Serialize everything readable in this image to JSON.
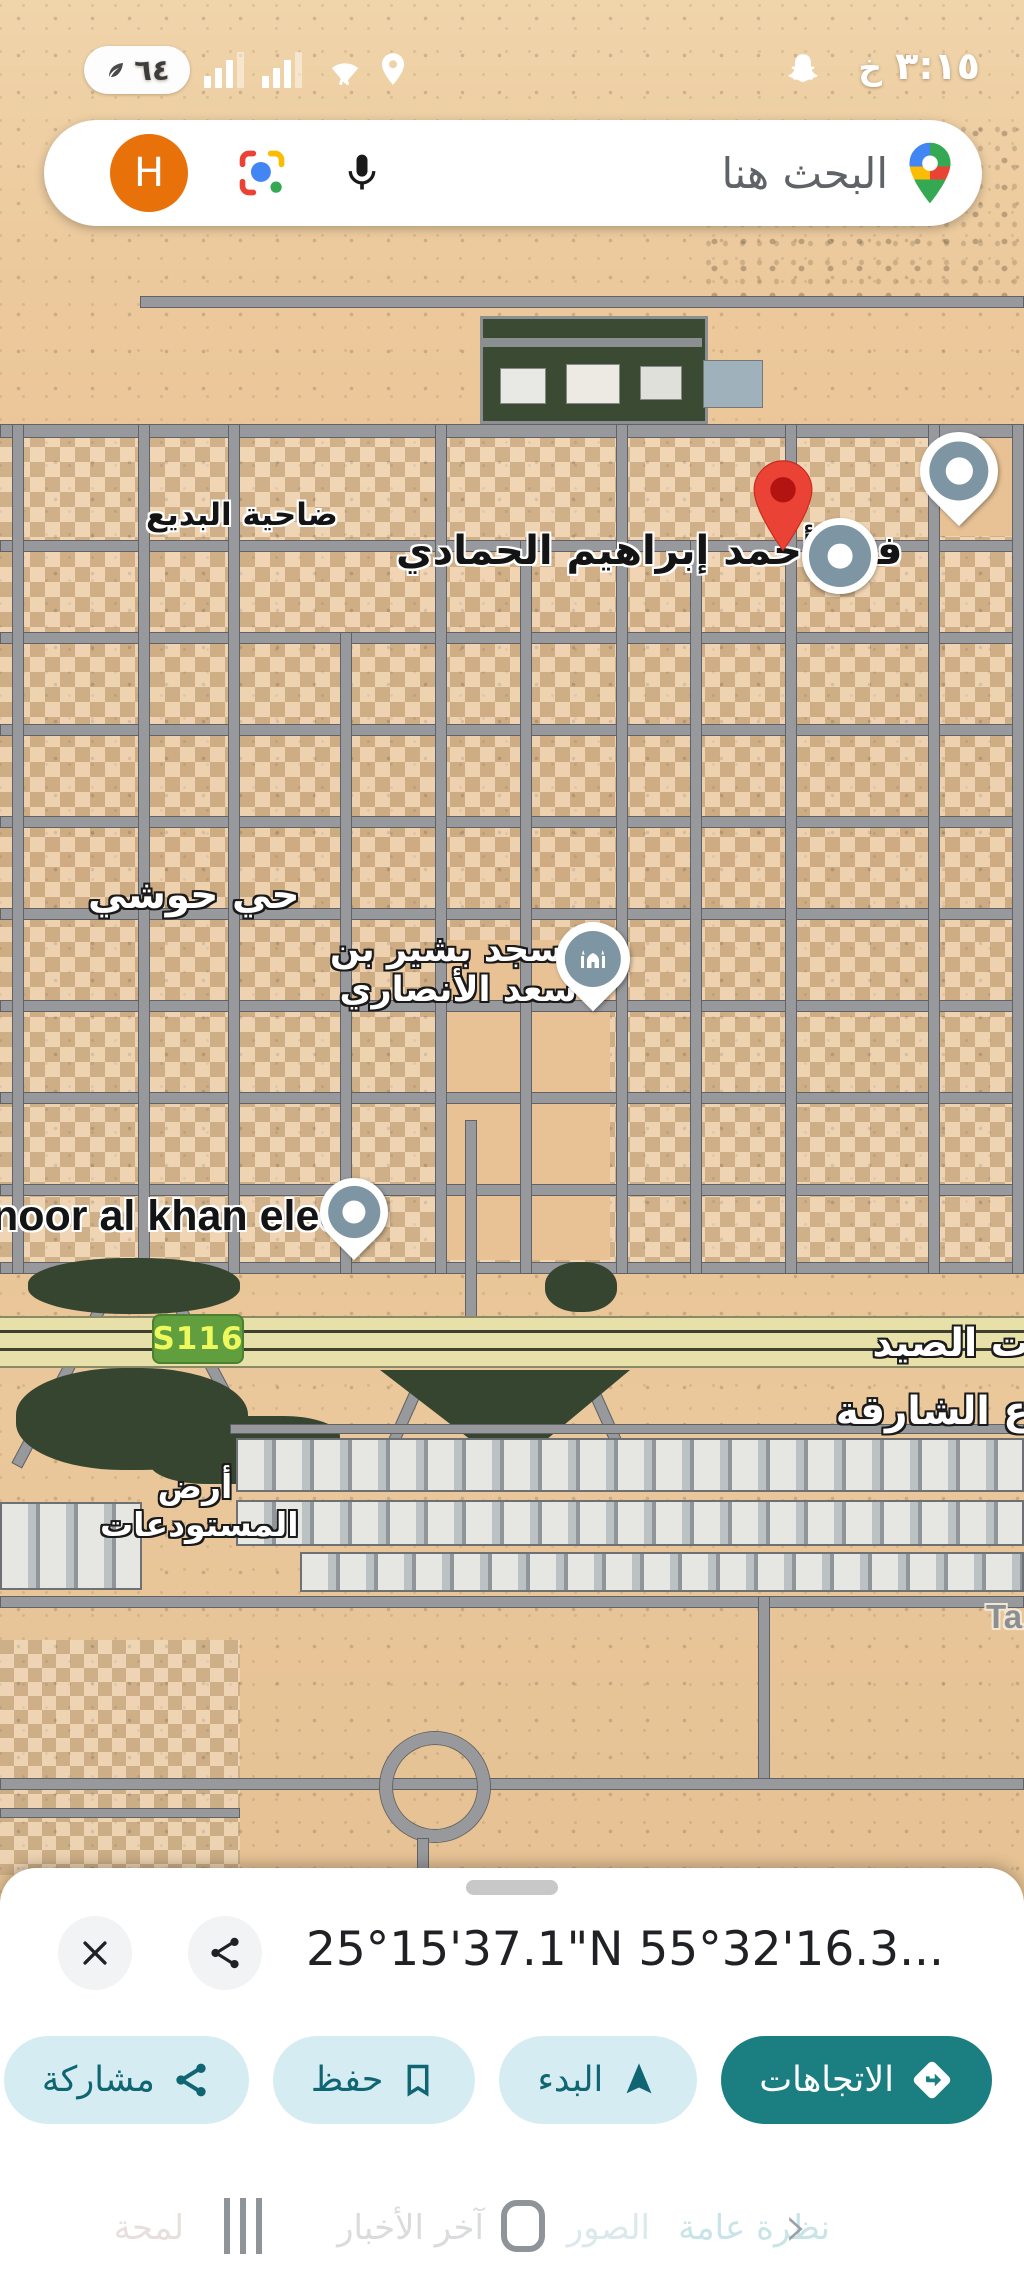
{
  "status_bar": {
    "time": "٣:١٥",
    "app_letter": "خ",
    "battery_percent": "٦٤"
  },
  "search_bar": {
    "query_placeholder": "البحث هنا",
    "avatar_initial": "H"
  },
  "map": {
    "labels": {
      "district_left": "ضاحية البديع",
      "villa": "فيلا أحمد إبراهيم الحمادي",
      "district_hawshi": "حي حوشي",
      "mosque_line1": "مسجد بشير بن",
      "mosque_line2": "سعد الأنصاري",
      "electrical": "noor al khan elect",
      "fishing_clipped": "ت الصيد",
      "sharjah_clipped": "ع الشارقة",
      "warehouses_line1": "أرض",
      "warehouses_line2": "المستودعات",
      "ta_clipped": "Ta",
      "route_badge": "S116"
    }
  },
  "bottom_sheet": {
    "title": "25°15'37.1\"N 55°32'16.3...",
    "actions": {
      "directions": "الاتجاهات",
      "start": "البدء",
      "save": "حفظ",
      "share": "مشاركة"
    },
    "tabs": {
      "overview": "نظرة عامة",
      "photos": "الصور",
      "news": "آخر الأخبار",
      "about": "لمحة"
    }
  },
  "colors": {
    "accent_teal": "#1b7f82",
    "chip_bg": "#d5edf2",
    "pin_red": "#ea4335",
    "poi_slate": "#7e95a3",
    "route_green": "#619e3e"
  }
}
